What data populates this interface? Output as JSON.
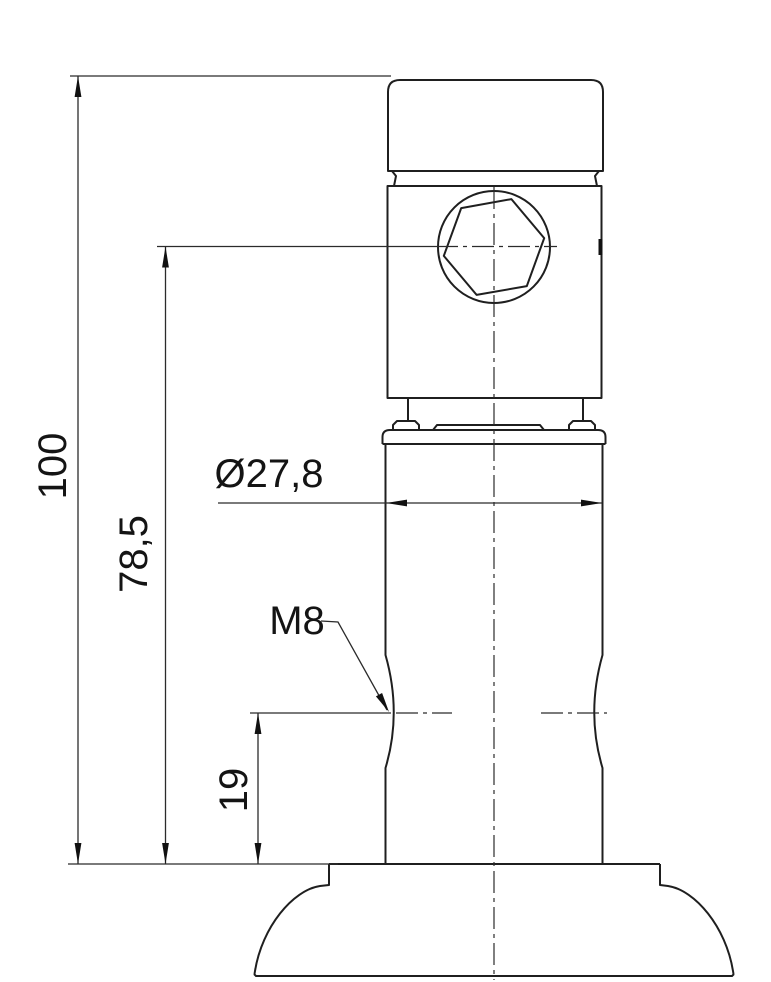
{
  "drawing": {
    "labels": {
      "overall_height": "100",
      "hex_center_height": "78,5",
      "thread_height": "19",
      "body_diameter": "Ø27,8",
      "thread_size": "M8"
    },
    "colors": {
      "line": "#1f1f1f",
      "background": "#ffffff"
    }
  }
}
